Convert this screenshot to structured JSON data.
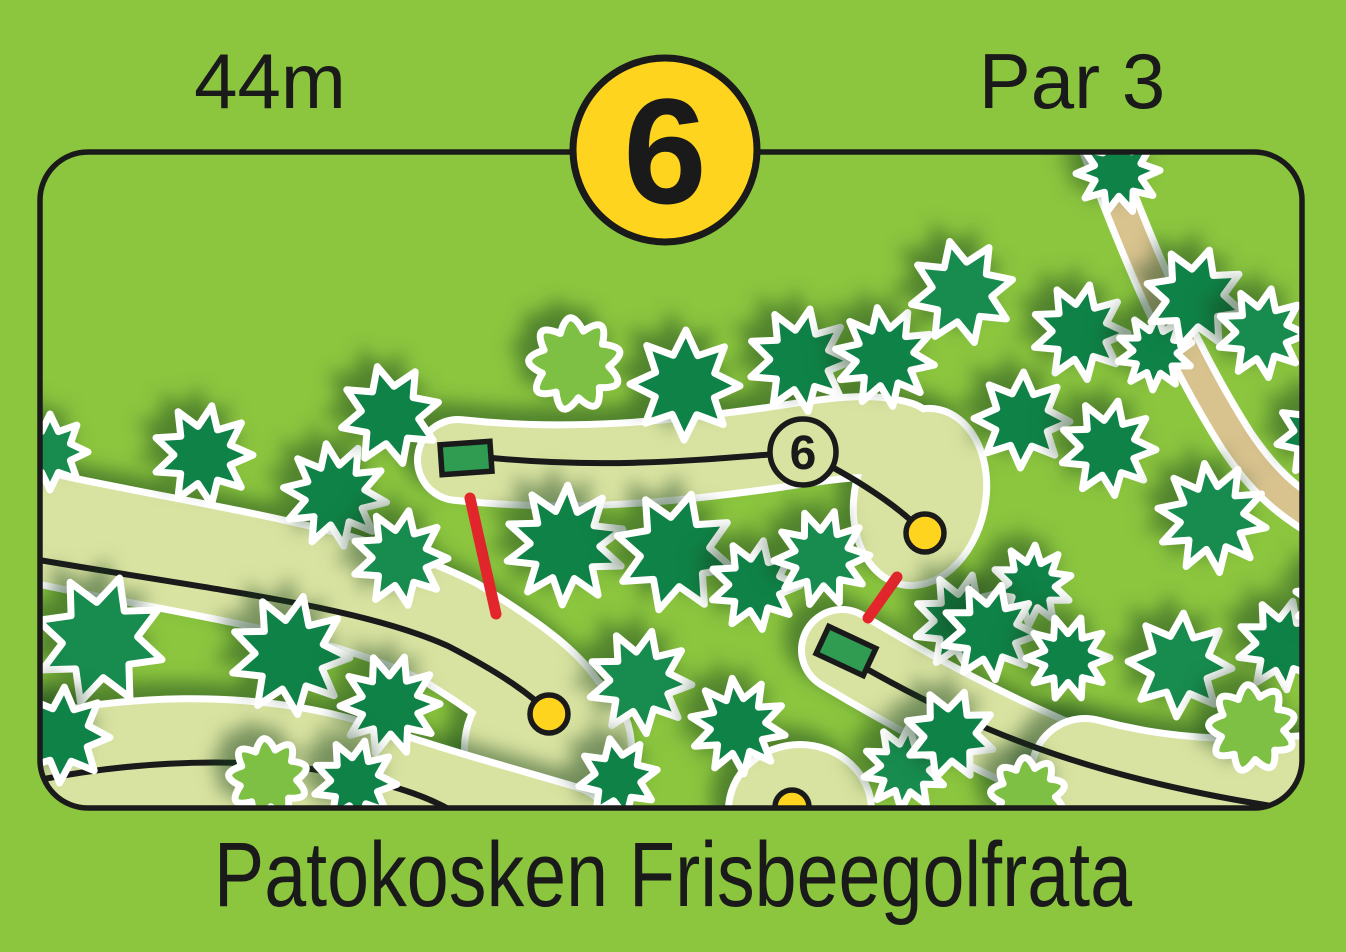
{
  "header": {
    "distance": "44m",
    "hole_number": "6",
    "par": "Par 3"
  },
  "footer": {
    "title": "Patokosken Frisbeegolfrata"
  },
  "colors": {
    "background_green": "#8CC63F",
    "fairway_green": "#D9E3A1",
    "conifer_dark": "#0F8347",
    "conifer_alt": "#178C4E",
    "bush_light": "#7DC043",
    "tee_green": "#2F9C52",
    "marker_yellow": "#FFD41F",
    "connector_red": "#E3262C",
    "path_tan": "#D8C28E",
    "outline_white": "#FFFFFF",
    "ink": "#1a1a1a"
  },
  "map": {
    "hole_label": "6",
    "border": {
      "x": 40,
      "y": 152,
      "w": 1262,
      "h": 656,
      "rx": 48
    },
    "badge": {
      "x": 665,
      "y": 150,
      "r": 92
    },
    "walking_path": {
      "d": "M 1096,140 C 1138,252 1180,352 1236,440 C 1264,482 1288,502 1322,522",
      "tan_width": 26,
      "white_width": 40
    },
    "fairways": [
      {
        "name": "left-band",
        "w": 104,
        "d": "M -30,512 C 170,560 330,572 450,632 C 515,672 540,694 552,712",
        "bulbs": [
          {
            "x": 548,
            "y": 748,
            "rx": 80,
            "ry": 80,
            "rot": 0
          }
        ]
      },
      {
        "name": "bottom-band",
        "w": 108,
        "d": "M -30,792 C 120,744 260,748 362,782 C 432,806 492,822 560,842",
        "bulbs": []
      },
      {
        "name": "hole6-fairway",
        "w": 74,
        "d": "M 458,460 C 570,472 670,462 770,448 C 830,439 868,432 900,442",
        "bulbs": [
          {
            "x": 920,
            "y": 497,
            "rx": 62,
            "ry": 86,
            "rot": 12
          }
        ]
      },
      {
        "name": "hole7-fairway",
        "w": 74,
        "d": "M 842,650 C 935,706 1035,756 1135,792 C 1205,815 1262,812 1320,802",
        "bulbs": []
      },
      {
        "name": "hole7-widening",
        "w": 100,
        "d": "M 1085,772 C 1160,792 1230,796 1318,788",
        "bulbs": []
      },
      {
        "name": "bottom-center-end",
        "w": 0,
        "d": "",
        "bulbs": [
          {
            "x": 800,
            "y": 810,
            "rx": 68,
            "ry": 62,
            "rot": 0
          }
        ]
      }
    ],
    "flight_lines": [
      {
        "hole": "left",
        "d": "M -30,548 C 190,588 350,602 448,646 C 506,676 532,696 549,713"
      },
      {
        "hole": "bottom",
        "d": "M -30,796 C 110,758 240,756 330,772 C 402,786 436,800 460,816"
      },
      {
        "hole": "6",
        "d": "M 492,458 C 620,470 716,458 803,452 C 856,478 898,506 922,531"
      },
      {
        "hole": "7",
        "d": "M 865,668 C 985,736 1105,782 1298,810"
      }
    ],
    "red_connectors": [
      {
        "x1": 470,
        "y1": 498,
        "x2": 496,
        "y2": 614
      },
      {
        "x1": 868,
        "y1": 618,
        "x2": 897,
        "y2": 577
      }
    ],
    "tees": [
      {
        "hole": "6",
        "x": 466,
        "y": 458,
        "w": 50,
        "h": 30,
        "angle": -4
      },
      {
        "hole": "7",
        "x": 846,
        "y": 651,
        "w": 52,
        "h": 30,
        "angle": 25
      }
    ],
    "baskets": [
      {
        "hole": "6",
        "x": 925,
        "y": 533,
        "r": 19
      },
      {
        "hole": "left",
        "x": 549,
        "y": 714,
        "r": 19
      },
      {
        "hole": "bottom-center",
        "x": 792,
        "y": 807,
        "r": 17
      }
    ],
    "hole_label_circle": {
      "x": 803,
      "y": 452,
      "r": 33
    },
    "trees": [
      {
        "x": 50,
        "y": 452,
        "r": 38,
        "t": "c"
      },
      {
        "x": 203,
        "y": 455,
        "r": 50,
        "t": "c"
      },
      {
        "x": 335,
        "y": 495,
        "r": 52,
        "t": "c"
      },
      {
        "x": 390,
        "y": 415,
        "r": 50,
        "t": "c"
      },
      {
        "x": 400,
        "y": 558,
        "r": 48,
        "t": "c"
      },
      {
        "x": 565,
        "y": 545,
        "r": 60,
        "t": "c"
      },
      {
        "x": 675,
        "y": 552,
        "r": 60,
        "t": "c"
      },
      {
        "x": 755,
        "y": 585,
        "r": 45,
        "t": "c"
      },
      {
        "x": 822,
        "y": 558,
        "r": 48,
        "t": "c"
      },
      {
        "x": 685,
        "y": 385,
        "r": 55,
        "t": "c"
      },
      {
        "x": 800,
        "y": 360,
        "r": 52,
        "t": "c"
      },
      {
        "x": 885,
        "y": 357,
        "r": 50,
        "t": "c"
      },
      {
        "x": 962,
        "y": 292,
        "r": 52,
        "t": "c"
      },
      {
        "x": 1080,
        "y": 332,
        "r": 48,
        "t": "c"
      },
      {
        "x": 1155,
        "y": 352,
        "r": 38,
        "t": "c"
      },
      {
        "x": 1195,
        "y": 298,
        "r": 50,
        "t": "c"
      },
      {
        "x": 1262,
        "y": 333,
        "r": 45,
        "t": "c"
      },
      {
        "x": 1118,
        "y": 172,
        "r": 42,
        "t": "c"
      },
      {
        "x": 1022,
        "y": 420,
        "r": 48,
        "t": "c"
      },
      {
        "x": 1108,
        "y": 448,
        "r": 48,
        "t": "c"
      },
      {
        "x": 1212,
        "y": 518,
        "r": 55,
        "t": "c"
      },
      {
        "x": 1318,
        "y": 435,
        "r": 42,
        "t": "c"
      },
      {
        "x": 962,
        "y": 622,
        "r": 48,
        "t": "c"
      },
      {
        "x": 1032,
        "y": 585,
        "r": 40,
        "t": "c"
      },
      {
        "x": 100,
        "y": 640,
        "r": 65,
        "t": "c"
      },
      {
        "x": 290,
        "y": 655,
        "r": 60,
        "t": "c"
      },
      {
        "x": 390,
        "y": 705,
        "r": 50,
        "t": "c"
      },
      {
        "x": 62,
        "y": 735,
        "r": 48,
        "t": "c"
      },
      {
        "x": 640,
        "y": 682,
        "r": 52,
        "t": "c"
      },
      {
        "x": 738,
        "y": 726,
        "r": 48,
        "t": "c"
      },
      {
        "x": 618,
        "y": 778,
        "r": 40,
        "t": "c"
      },
      {
        "x": 355,
        "y": 782,
        "r": 42,
        "t": "c"
      },
      {
        "x": 905,
        "y": 768,
        "r": 42,
        "t": "c"
      },
      {
        "x": 950,
        "y": 735,
        "r": 45,
        "t": "c"
      },
      {
        "x": 990,
        "y": 632,
        "r": 48,
        "t": "c"
      },
      {
        "x": 1068,
        "y": 658,
        "r": 42,
        "t": "c"
      },
      {
        "x": 1180,
        "y": 665,
        "r": 52,
        "t": "c"
      },
      {
        "x": 1282,
        "y": 645,
        "r": 45,
        "t": "c"
      },
      {
        "x": 1335,
        "y": 600,
        "r": 40,
        "t": "c"
      },
      {
        "x": 575,
        "y": 364,
        "r": 47,
        "t": "b"
      },
      {
        "x": 1252,
        "y": 728,
        "r": 44,
        "t": "b"
      },
      {
        "x": 268,
        "y": 778,
        "r": 40,
        "t": "b"
      },
      {
        "x": 1028,
        "y": 795,
        "r": 38,
        "t": "b"
      }
    ]
  }
}
